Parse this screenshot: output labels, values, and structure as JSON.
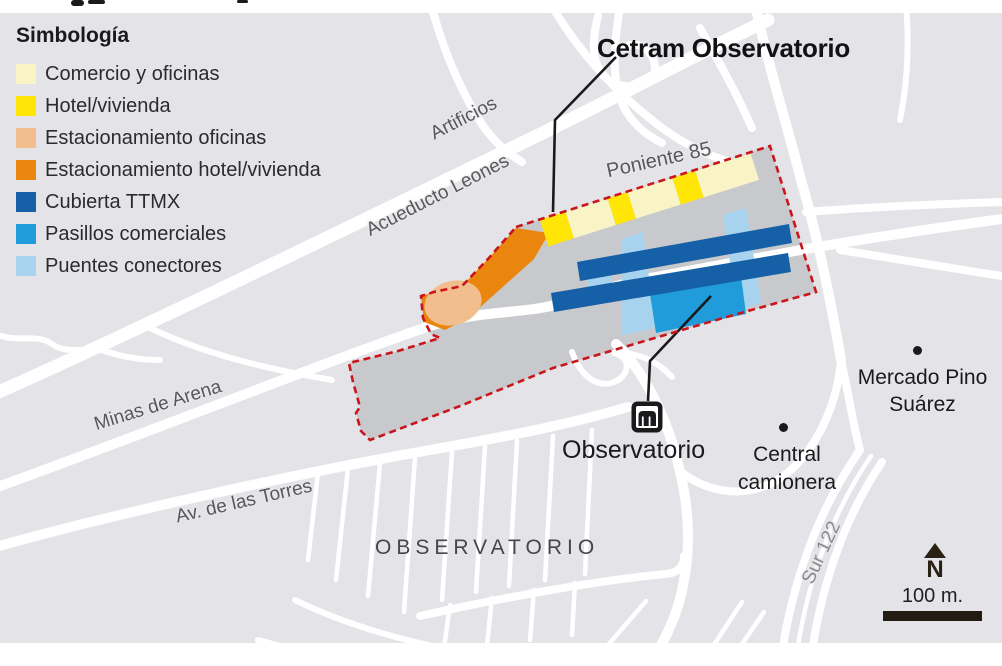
{
  "legend": {
    "title": "Simbología",
    "items": [
      {
        "label": "Comercio y oficinas",
        "color": "#F9F4C6"
      },
      {
        "label": "Hotel/vivienda",
        "color": "#FFE607"
      },
      {
        "label": "Estacionamiento oficinas",
        "color": "#F3BE8E"
      },
      {
        "label": "Estacionamiento hotel/vivienda",
        "color": "#EA860E"
      },
      {
        "label": "Cubierta TTMX",
        "color": "#1560A7"
      },
      {
        "label": "Pasillos comerciales",
        "color": "#1F9CD9"
      },
      {
        "label": "Puentes conectores",
        "color": "#A8D3EE"
      }
    ]
  },
  "map": {
    "callout_title": "Cetram Observatorio",
    "street_labels": {
      "artificios": "Artificios",
      "acueducto": "Acueducto Leones",
      "poniente": "Poniente 85",
      "minas": "Minas de Arena",
      "torres": "Av. de las Torres",
      "sur": "Sur 122"
    },
    "area_label": "OBSERVATORIO",
    "pois": {
      "metro_station": "Observatorio",
      "bus_terminal": "Central camionera",
      "market": "Mercado Pino Suárez"
    },
    "compass_label": "N",
    "scale_label": "100 m.",
    "colors": {
      "land": "#E4E4E8",
      "site_fill": "#C8C9CD",
      "site_outline": "#C9151B",
      "road": "#FFFFFF",
      "leader_line": "#1A1A1C"
    }
  },
  "source": "Fuente: Seduvi"
}
